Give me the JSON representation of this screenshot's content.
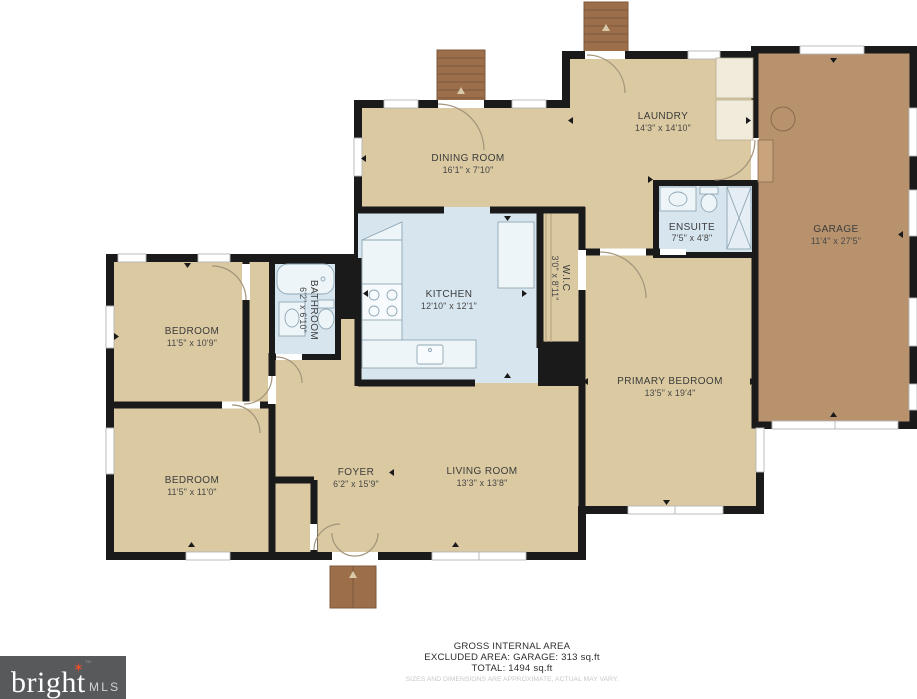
{
  "plan_title": "floor-plan",
  "colors": {
    "wall": "#1a1a1a",
    "floor": "#dac9a1",
    "garage_floor": "#b8926d",
    "wet_room": "#d6e5ee",
    "steps": "#9c6f4a",
    "logo_bg": "#58595b",
    "logo_star": "#e4502e"
  },
  "rooms": [
    {
      "name": "DINING ROOM",
      "dims": "16'1\" x 7'10\""
    },
    {
      "name": "LAUNDRY",
      "dims": "14'3\" x 14'10\""
    },
    {
      "name": "GARAGE",
      "dims": "11'4\" x 27'5\""
    },
    {
      "name": "KITCHEN",
      "dims": "12'10\" x 12'1\""
    },
    {
      "name": "ENSUITE",
      "dims": "7'5\" x 4'8\""
    },
    {
      "name": "W.I.C",
      "dims": "3'0\" x 8'11\""
    },
    {
      "name": "BATHROOM",
      "dims": "6'2\" x 6'10\""
    },
    {
      "name": "BEDROOM",
      "dims": "11'5\" x 10'9\""
    },
    {
      "name": "BEDROOM",
      "dims": "11'5\" x 11'0\""
    },
    {
      "name": "PRIMARY BEDROOM",
      "dims": "13'5\" x 19'4\""
    },
    {
      "name": "FOYER",
      "dims": "6'2\" x 15'9\""
    },
    {
      "name": "LIVING ROOM",
      "dims": "13'3\" x 13'8\""
    }
  ],
  "footer": {
    "line1": "GROSS INTERNAL AREA",
    "line2": "EXCLUDED AREA: GARAGE: 313 sq.ft",
    "line3": "TOTAL: 1494 sq.ft",
    "disclaimer": "SIZES AND DIMENSIONS ARE APPROXIMATE, ACTUAL MAY VARY."
  },
  "brand": {
    "name": "bright",
    "suffix": "MLS",
    "tm": "TM",
    "star": "✶"
  }
}
